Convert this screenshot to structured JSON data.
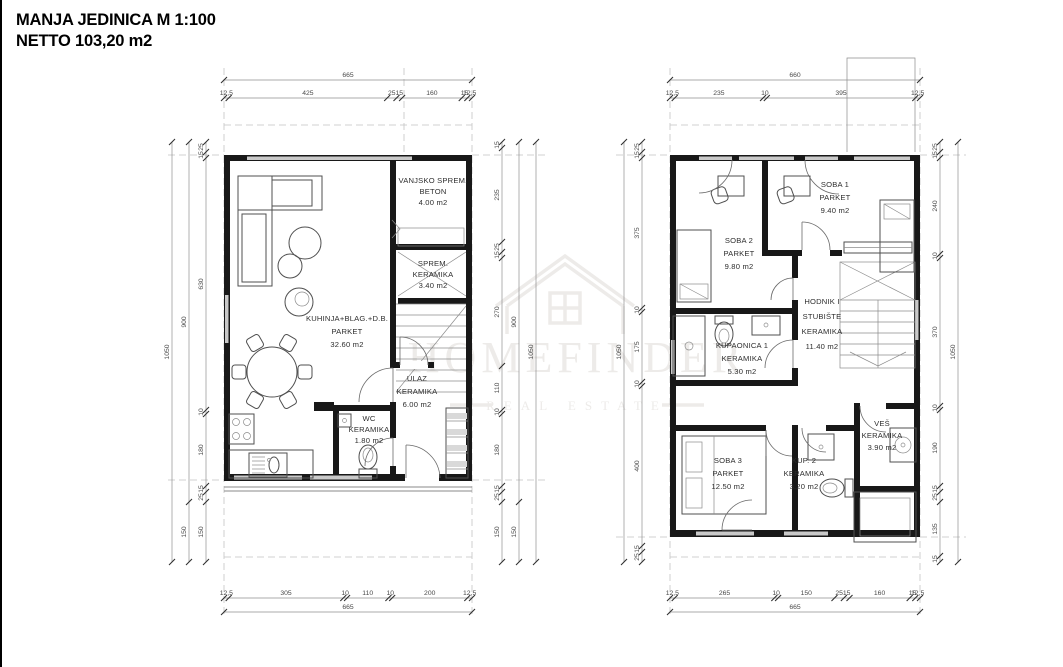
{
  "title": {
    "line1": "MANJA JEDINICA M 1:100",
    "line2": "NETTO 103,20 m2"
  },
  "watermark": {
    "name": "HOMEFINDER",
    "tagline": "REAL ESTATE"
  },
  "plans": {
    "ground": {
      "rooms": [
        {
          "name": "VANJSKO SPREM.",
          "floor": "BETON",
          "area": "4.00 m2"
        },
        {
          "name": "SPREM.",
          "floor": "KERAMIKA",
          "area": "3.40 m2"
        },
        {
          "name": "KUHINJA+BLAG.+D.B.",
          "floor": "PARKET",
          "area": "32.60 m2"
        },
        {
          "name": "ULAZ",
          "floor": "KERAMIKA",
          "area": "6.00 m2"
        },
        {
          "name": "WC",
          "floor": "KERAMIKA",
          "area": "1.80 m2"
        }
      ],
      "dims": {
        "top": {
          "total": "665",
          "segments": [
            "12,5",
            "425",
            "25",
            "15",
            "160",
            "15",
            "12,5"
          ]
        },
        "bottom": {
          "total": "665",
          "segments": [
            "12,5",
            "305",
            "10",
            "110",
            "10",
            "200",
            "12,5"
          ]
        },
        "left": {
          "total": "1050",
          "mid": [
            "900",
            "150"
          ],
          "segments": [
            "25",
            "15",
            "630",
            "10",
            "180",
            "15",
            "25",
            "150"
          ]
        },
        "right": {
          "total": "1050",
          "mid": [
            "900",
            "150"
          ],
          "segments": [
            "15",
            "235",
            "25",
            "15",
            "270",
            "110",
            "10",
            "180",
            "15",
            "25",
            "150"
          ]
        }
      }
    },
    "floor": {
      "rooms": [
        {
          "name": "SOBA 1",
          "floor": "PARKET",
          "area": "9.40 m2"
        },
        {
          "name": "SOBA 2",
          "floor": "PARKET",
          "area": "9.80 m2"
        },
        {
          "name": "HODNIK I",
          "name2": "STUBIŠTE",
          "floor": "KERAMIKA",
          "area": "11.40 m2"
        },
        {
          "name": "KUPAONICA 1",
          "floor": "KERAMIKA",
          "area": "5.30 m2"
        },
        {
          "name": "SOBA 3",
          "floor": "PARKET",
          "area": "12.50 m2"
        },
        {
          "name": "KUP. 2",
          "floor": "KERAMIKA",
          "area": "3.20 m2"
        },
        {
          "name": "VEŠ",
          "floor": "KERAMIKA",
          "area": "3.90 m2"
        }
      ],
      "dims": {
        "top": {
          "total": "660",
          "segments": [
            "12,5",
            "235",
            "10",
            "395",
            "12,5"
          ]
        },
        "bottom": {
          "total": "665",
          "segments": [
            "12,5",
            "265",
            "10",
            "150",
            "25",
            "15",
            "160",
            "15",
            "12,5"
          ]
        },
        "left": {
          "total": "1050",
          "segments": [
            "25",
            "15",
            "375",
            "10",
            "175",
            "10",
            "400",
            "15",
            "25"
          ]
        },
        "right": {
          "total": "1050",
          "segments": [
            "25",
            "15",
            "240",
            "10",
            "370",
            "10",
            "190",
            "15",
            "25",
            "135",
            "15"
          ]
        }
      }
    }
  }
}
